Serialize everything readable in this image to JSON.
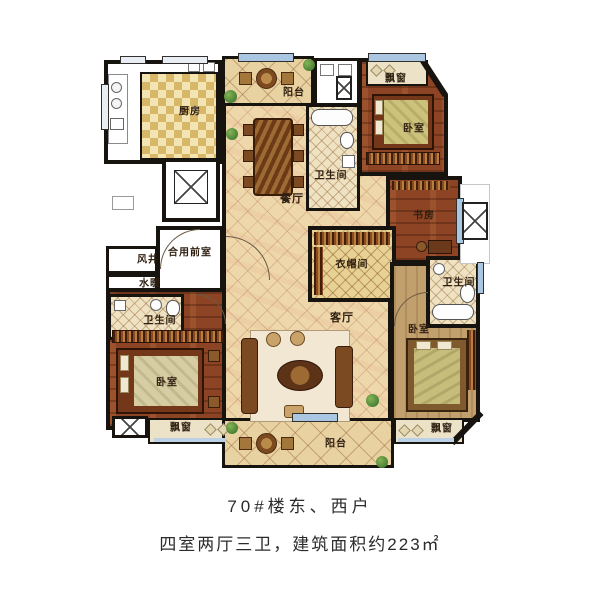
{
  "plan": {
    "rooms": {
      "kitchen": "厨房",
      "balcony_top": "阳台",
      "dining": "餐厅",
      "bath_mid": "卫生间",
      "baywin_tr": "飘窗",
      "bedroom_tr": "卧室",
      "study": "书房",
      "bath_right": "卫生间",
      "bedroom_br": "卧室",
      "baywin_br": "飘窗",
      "closet": "衣帽间",
      "living": "客厅",
      "front_room": "合用前室",
      "wind_shaft": "风井",
      "plumbing": "水暖",
      "bath_left": "卫生间",
      "bedroom_bl": "卧室",
      "baywin_bl": "飘窗",
      "balcony_bottom": "阳台"
    },
    "caption": {
      "line1": "70#楼东、西户",
      "line2": "四室两厅三卫，建筑面积约223㎡"
    },
    "colors": {
      "wall": "#17130e",
      "window_glass": "#aac6e0",
      "wood_floor": "#8d4424",
      "tile_floor": "#eed7ab"
    }
  }
}
